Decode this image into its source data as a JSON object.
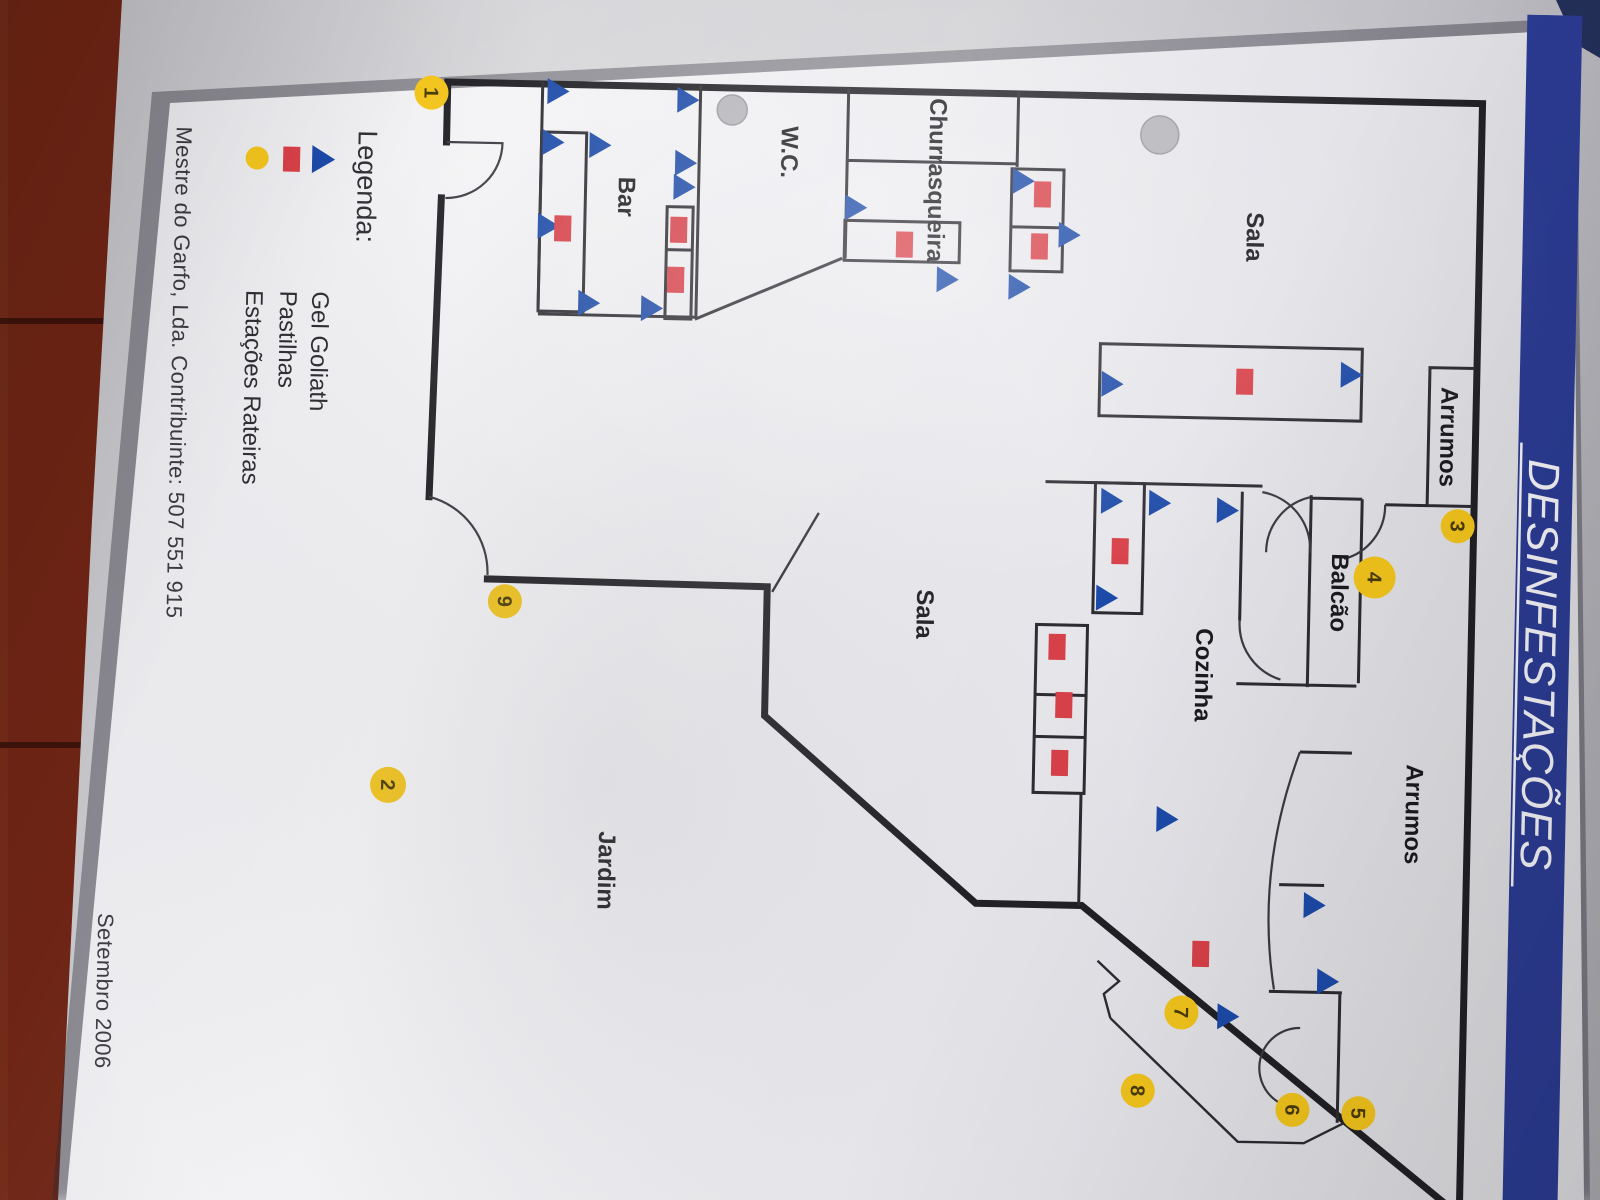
{
  "title": {
    "banner_text": "DESINFESTAÇÕES"
  },
  "legend": {
    "heading": "Legenda:",
    "items": [
      {
        "icon": "gel-triangle-icon",
        "label": "Gel Goliath"
      },
      {
        "icon": "pastilha-square-icon",
        "label": "Pastilhas"
      },
      {
        "icon": "station-circle-icon",
        "label": "Estações Rateiras"
      }
    ]
  },
  "footer": {
    "company_line": "Mestre do Garfo, Lda. Contribuinte: 507 551 915",
    "date": "Setembro 2006"
  },
  "colors": {
    "banner": "#2b3b92",
    "gel": "#1c4aa8",
    "pastilha": "#d84048",
    "station": "#f2c41c",
    "paper": "#efeff2"
  },
  "floorplan": {
    "rooms": [
      {
        "name": "Sala",
        "x": 228,
        "y": 316
      },
      {
        "name": "Arrumos",
        "x": 424,
        "y": 118
      },
      {
        "name": "Balcão",
        "x": 582,
        "y": 224
      },
      {
        "name": "Cozinha",
        "x": 667,
        "y": 358
      },
      {
        "name": "Arrumos",
        "x": 802,
        "y": 145
      },
      {
        "name": "Sala",
        "x": 612,
        "y": 638
      },
      {
        "name": "Jardim",
        "x": 875,
        "y": 951
      },
      {
        "name": "W.C.",
        "x": 153,
        "y": 783
      },
      {
        "name": "Bar",
        "x": 201,
        "y": 945
      },
      {
        "name": "Churrasqueira",
        "x": 178,
        "y": 635
      }
    ],
    "gel_points": [
      [
        97,
        1008
      ],
      [
        148,
        1012
      ],
      [
        150,
        965
      ],
      [
        232,
        1015
      ],
      [
        308,
        973
      ],
      [
        312,
        910
      ],
      [
        103,
        878
      ],
      [
        166,
        879
      ],
      [
        190,
        880
      ],
      [
        207,
        708
      ],
      [
        277,
        615
      ],
      [
        177,
        541
      ],
      [
        230,
        494
      ],
      [
        283,
        543
      ],
      [
        378,
        448
      ],
      [
        364,
        209
      ],
      [
        495,
        446
      ],
      [
        496,
        398
      ],
      [
        502,
        330
      ],
      [
        592,
        449
      ],
      [
        812,
        384
      ],
      [
        895,
        235
      ],
      [
        971,
        220
      ],
      [
        1008,
        319
      ]
    ],
    "pastilha_points": [
      [
        234,
        1000
      ],
      [
        233,
        884
      ],
      [
        283,
        886
      ],
      [
        243,
        658
      ],
      [
        190,
        521
      ],
      [
        242,
        523
      ],
      [
        373,
        315
      ],
      [
        545,
        436
      ],
      [
        642,
        497
      ],
      [
        700,
        489
      ],
      [
        758,
        492
      ],
      [
        946,
        347
      ]
    ],
    "stations": [
      {
        "n": "1",
        "x": 101,
        "y": 1134,
        "r": 17
      },
      {
        "n": "2",
        "x": 794,
        "y": 1163,
        "r": 18
      },
      {
        "n": "3",
        "x": 513,
        "y": 99,
        "r": 17
      },
      {
        "n": "4",
        "x": 566,
        "y": 181,
        "r": 21
      },
      {
        "n": "5",
        "x": 1102,
        "y": 186,
        "r": 17
      },
      {
        "n": "6",
        "x": 1100,
        "y": 252,
        "r": 17
      },
      {
        "n": "7",
        "x": 1005,
        "y": 365,
        "r": 17
      },
      {
        "n": "8",
        "x": 1084,
        "y": 407,
        "r": 17
      },
      {
        "n": "9",
        "x": 608,
        "y": 1050,
        "r": 17
      }
    ]
  }
}
